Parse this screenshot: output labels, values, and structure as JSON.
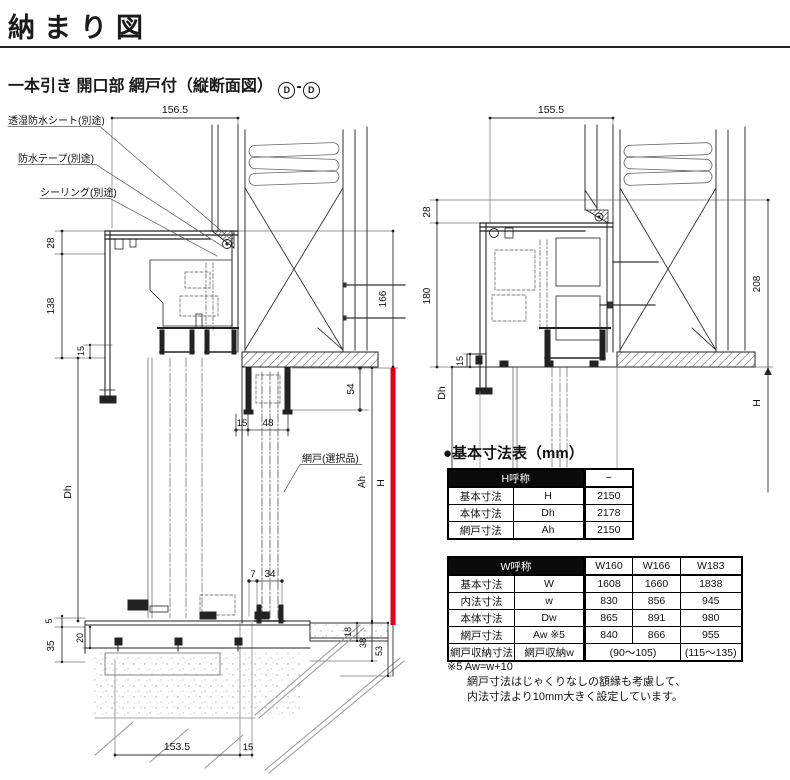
{
  "header": {
    "title": "納まり図"
  },
  "subtitle": {
    "text": "一本引き 開口部 網戸付（縦断面図）",
    "mark1": "D",
    "dash": "-",
    "mark2": "D"
  },
  "left": {
    "w_top": "156.5",
    "callout_sheet": "透湿防水シート(別途)",
    "callout_tape": "防水テープ(別途)",
    "callout_seal": "シーリング(別途)",
    "callout_screen": "網戸(選択品)",
    "d28": "28",
    "d138": "138",
    "d15_head": "15",
    "dh": "Dh",
    "d5": "5",
    "d20": "20",
    "d35": "35",
    "d166": "166",
    "d54": "54",
    "d15_pocket": "15",
    "d48": "48",
    "d7": "7",
    "d34": "34",
    "ah": "Ah",
    "h": "H",
    "d18": "18",
    "d38": "38",
    "d53": "53",
    "w_bottom": "153.5",
    "d15_bottom": "15"
  },
  "right": {
    "w_top": "155.5",
    "d28": "28",
    "d180": "180",
    "d15": "15",
    "dh": "Dh",
    "d208": "208",
    "h": "H"
  },
  "tables": {
    "heading": "●基本寸法表（mm）",
    "h_table": {
      "name": "H呼称",
      "col": "−",
      "rows": [
        {
          "label": "基本寸法",
          "sym": "H",
          "val": "2150"
        },
        {
          "label": "本体寸法",
          "sym": "Dh",
          "val": "2178"
        },
        {
          "label": "網戸寸法",
          "sym": "Ah",
          "val": "2150"
        }
      ]
    },
    "w_table": {
      "name": "W呼称",
      "cols": [
        "W160",
        "W166",
        "W183"
      ],
      "rows": [
        {
          "label": "基本寸法",
          "sym": "W",
          "vals": [
            "1608",
            "1660",
            "1838"
          ]
        },
        {
          "label": "内法寸法",
          "sym": "w",
          "vals": [
            "830",
            "856",
            "945"
          ]
        },
        {
          "label": "本体寸法",
          "sym": "Dw",
          "vals": [
            "865",
            "891",
            "980"
          ]
        },
        {
          "label": "網戸寸法",
          "sym": "Aw ※5",
          "vals": [
            "840",
            "866",
            "955"
          ]
        }
      ],
      "storage": {
        "label": "網戸収納寸法",
        "sym": "網戸収納w",
        "span_val": "(90〜105)",
        "last_val": "(115〜135)"
      }
    }
  },
  "note": {
    "l1": "※5 Aw=w+10",
    "l2": "網戸寸法はじゃくりなしの額縁も考慮して、",
    "l3": "内法寸法より10mm大きく設定しています。"
  },
  "colors": {
    "accent_red": "#e60012"
  }
}
